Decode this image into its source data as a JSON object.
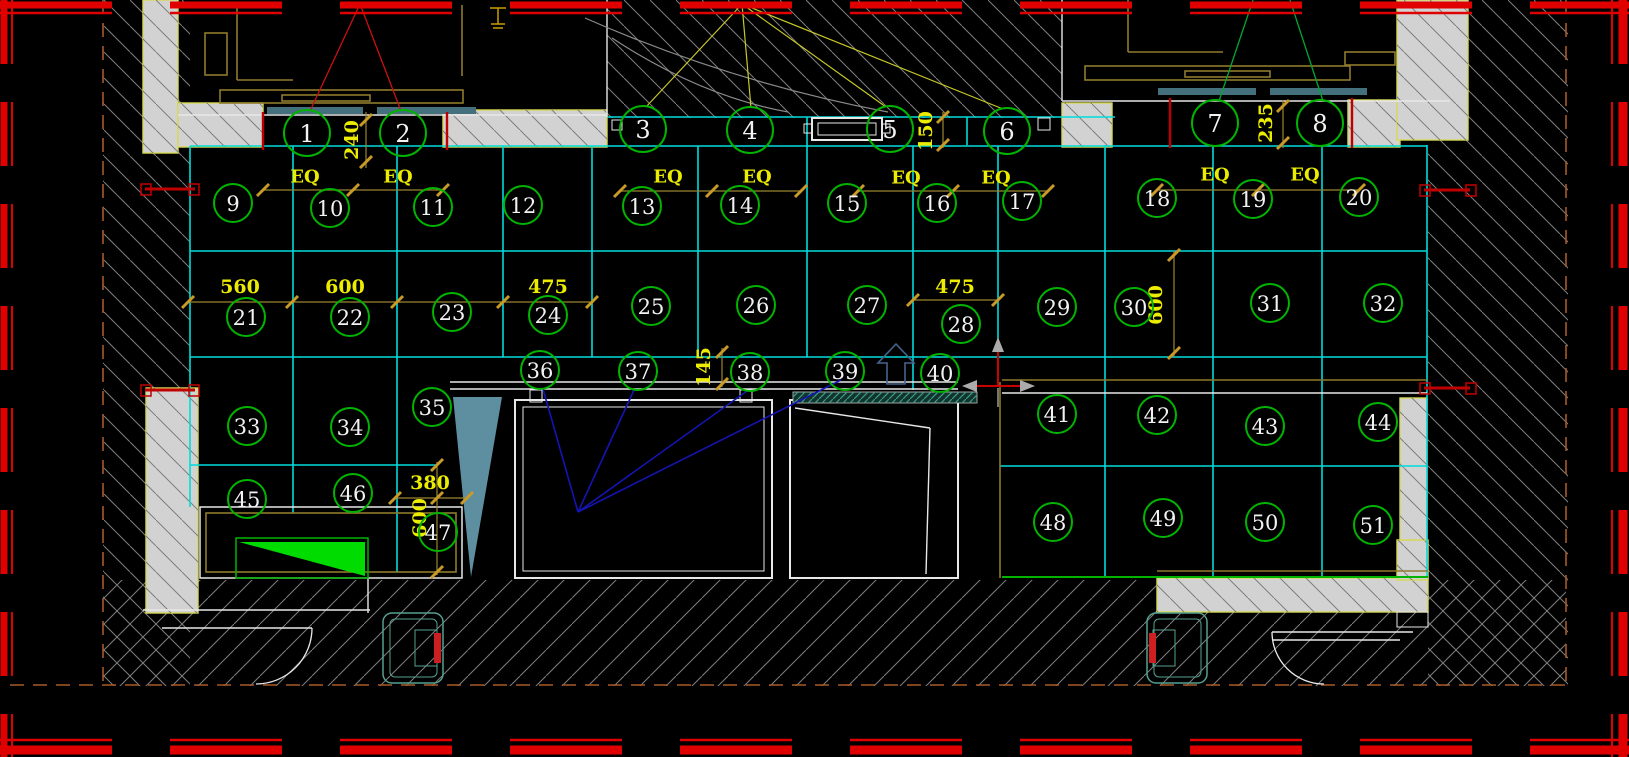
{
  "canvas": {
    "w": 1629,
    "h": 757
  },
  "colors": {
    "bg": "#000000",
    "red": "#E00000",
    "red_dark": "#C00000",
    "orange_dash": "#A85A28",
    "hatch": "#7E7E7E",
    "gray_wall": "#D2D2D2",
    "wall_edge": "#D8D855",
    "cyan": "#00DCDC",
    "white": "#E8E8E8",
    "khaki": "#8F7A2E",
    "gold": "#C89B28",
    "yellow_text": "#ECEC00",
    "circle_green": "#00B400",
    "leader_red": "#CC1010",
    "leader_yellow": "#C8C828",
    "leader_green": "#00A830",
    "leader_blue": "#1414B4",
    "teal_bar": "#44707E",
    "steel_tri": "#5E8FA0",
    "green_fill": "#00DC00",
    "door_teal": "#55A090",
    "arc_gray": "#8A8A8A",
    "ucs_gray": "#ABABAB",
    "arrow_blue": "#46648C",
    "strip_fill": "#12342E"
  },
  "border": {
    "top": [
      {
        "y": 5,
        "sw": 7
      },
      {
        "y": 13,
        "sw": 2.5
      }
    ],
    "bottom": [
      {
        "y": 740,
        "sw": 2.5
      },
      {
        "y": 750,
        "sw": 9
      }
    ],
    "left": [
      {
        "x": 4,
        "sw": 7
      },
      {
        "x": 12,
        "sw": 2
      }
    ],
    "right": [
      {
        "x": 1612,
        "sw": 2
      },
      {
        "x": 1623,
        "sw": 9
      }
    ],
    "dash_h": "112 58",
    "dash_v": "64 38"
  },
  "orange_dashes": [
    [
      103,
      0,
      103,
      685
    ],
    [
      1566,
      0,
      1566,
      685
    ],
    [
      10,
      685,
      1566,
      685
    ]
  ],
  "hatch_back": [
    [
      103,
      0,
      87,
      686
    ],
    [
      607,
      0,
      455,
      118
    ],
    [
      1428,
      0,
      140,
      686
    ]
  ],
  "hatch_fwd": [
    [
      103,
      580,
      1463,
      106
    ]
  ],
  "gray_walls": [
    [
      143,
      0,
      35,
      153
    ],
    [
      178,
      103,
      85,
      44
    ],
    [
      443,
      110,
      164,
      37
    ],
    [
      1062,
      103,
      50,
      44
    ],
    [
      1348,
      100,
      52,
      47
    ],
    [
      1397,
      0,
      71,
      140
    ],
    [
      146,
      388,
      52,
      225
    ],
    [
      1157,
      578,
      271,
      34
    ],
    [
      1397,
      540,
      31,
      40
    ],
    [
      1400,
      398,
      27,
      142
    ]
  ],
  "grid_h": [
    [
      117,
      607,
      1115
    ],
    [
      146,
      190,
      1427
    ],
    [
      251,
      190,
      1427
    ],
    [
      357,
      190,
      1427
    ],
    [
      465,
      190,
      437
    ],
    [
      466,
      1000,
      1427
    ]
  ],
  "grid_v": [
    [
      190,
      146,
      507
    ],
    [
      293,
      146,
      513
    ],
    [
      397,
      146,
      572
    ],
    [
      503,
      146,
      357
    ],
    [
      592,
      146,
      357
    ],
    [
      698,
      146,
      357
    ],
    [
      807,
      117,
      357
    ],
    [
      913,
      146,
      390
    ],
    [
      967,
      117,
      145
    ],
    [
      998,
      146,
      382
    ],
    [
      1105,
      145,
      578
    ],
    [
      1213,
      145,
      578
    ],
    [
      1322,
      145,
      578
    ],
    [
      1427,
      145,
      578
    ]
  ],
  "white_lines": [
    [
      178,
      115,
      607,
      115
    ],
    [
      1062,
      101,
      1450,
      101
    ],
    [
      450,
      382,
      958,
      382
    ],
    [
      450,
      389,
      958,
      389
    ],
    [
      607,
      0,
      607,
      117
    ],
    [
      1062,
      0,
      1062,
      101
    ],
    [
      795,
      408,
      930,
      428
    ],
    [
      930,
      428,
      926,
      574
    ],
    [
      143,
      610,
      370,
      610
    ],
    [
      162,
      628,
      312,
      628
    ],
    [
      368,
      578,
      368,
      613
    ],
    [
      1272,
      632,
      1413,
      632
    ],
    [
      1272,
      640,
      1400,
      640
    ],
    [
      1002,
      393,
      1427,
      393
    ]
  ],
  "white_rects": [
    [
      515,
      400,
      257,
      178,
      2
    ],
    [
      523,
      407,
      241,
      164,
      1
    ],
    [
      790,
      400,
      168,
      178,
      2
    ],
    [
      812,
      118,
      70,
      22,
      2
    ],
    [
      818,
      123,
      58,
      12,
      1
    ],
    [
      804,
      124,
      8,
      9,
      1
    ],
    [
      882,
      124,
      8,
      9,
      1
    ],
    [
      612,
      120,
      10,
      10,
      1
    ],
    [
      1038,
      118,
      12,
      12,
      1
    ],
    [
      530,
      390,
      12,
      12,
      1
    ],
    [
      740,
      390,
      12,
      12,
      1
    ],
    [
      200,
      507,
      262,
      71,
      1.5
    ],
    [
      1397,
      612,
      31,
      15,
      1
    ]
  ],
  "khaki_lines": [
    [
      237,
      8,
      237,
      80
    ],
    [
      237,
      80,
      293,
      80
    ],
    [
      462,
      5,
      462,
      76
    ],
    [
      1128,
      0,
      1128,
      52
    ],
    [
      1128,
      52,
      1223,
      52
    ],
    [
      1000,
      382,
      1000,
      578
    ],
    [
      1002,
      380,
      1427,
      380
    ],
    [
      1157,
      571,
      1428,
      571
    ]
  ],
  "khaki_rects": [
    [
      205,
      33,
      22,
      42
    ],
    [
      220,
      90,
      243,
      13
    ],
    [
      282,
      95,
      88,
      6
    ],
    [
      1085,
      66,
      265,
      14
    ],
    [
      1185,
      71,
      85,
      6
    ],
    [
      1345,
      52,
      50,
      13
    ],
    [
      206,
      513,
      250,
      59
    ]
  ],
  "teal_bars": [
    [
      267,
      107,
      96,
      7
    ],
    [
      377,
      107,
      99,
      7
    ],
    [
      1158,
      88,
      98,
      7
    ],
    [
      1270,
      88,
      97,
      7
    ]
  ],
  "teal_strip": [
    793,
    392,
    184,
    11
  ],
  "door_boxes": [
    {
      "x": 383,
      "y": 613,
      "w": 60,
      "h": 70,
      "red_side": "right"
    },
    {
      "x": 1147,
      "y": 613,
      "w": 60,
      "h": 70,
      "red_side": "left"
    }
  ],
  "green_line": [
    1002,
    577,
    1428,
    577
  ],
  "green_block": {
    "outline": [
      236,
      538,
      132,
      40
    ],
    "tri": "M 239 542 L 365 542 L 365 576 Z"
  },
  "red_pocket_ticks": [
    [
      263,
      112,
      263,
      150
    ],
    [
      447,
      112,
      447,
      150
    ],
    [
      1170,
      98,
      1170,
      148
    ],
    [
      1352,
      98,
      1352,
      148
    ]
  ],
  "red_openings": {
    "bars": [
      [
        145,
        189,
        195,
        189
      ],
      [
        145,
        390,
        195,
        390
      ],
      [
        1424,
        190,
        1470,
        190
      ],
      [
        1424,
        388,
        1470,
        388
      ]
    ],
    "caps": [
      [
        141,
        184,
        10,
        11
      ],
      [
        189,
        184,
        10,
        11
      ],
      [
        141,
        385,
        10,
        11
      ],
      [
        189,
        385,
        10,
        11
      ],
      [
        1420,
        185,
        10,
        11
      ],
      [
        1466,
        185,
        10,
        11
      ],
      [
        1420,
        383,
        10,
        11
      ],
      [
        1466,
        383,
        10,
        11
      ]
    ]
  },
  "leaders": {
    "red": [
      [
        360,
        4,
        310,
        111
      ],
      [
        360,
        4,
        401,
        111
      ]
    ],
    "yellow": [
      [
        742,
        4,
        646,
        107
      ],
      [
        742,
        4,
        751,
        108
      ],
      [
        742,
        4,
        886,
        107
      ],
      [
        742,
        4,
        1003,
        109
      ]
    ],
    "green": [
      [
        1253,
        0,
        1219,
        101
      ],
      [
        1290,
        0,
        1323,
        101
      ]
    ],
    "blue": [
      [
        578,
        512,
        543,
        389
      ],
      [
        578,
        512,
        634,
        390
      ],
      [
        578,
        512,
        747,
        391
      ],
      [
        578,
        512,
        841,
        380
      ]
    ]
  },
  "dims": {
    "lines_h": [
      [
        190,
        263,
        443
      ],
      [
        191,
        620,
        801
      ],
      [
        191,
        858,
        1048
      ],
      [
        190,
        1157,
        1359
      ],
      [
        302,
        188,
        592
      ],
      [
        300,
        913,
        998
      ],
      [
        498,
        395,
        467
      ]
    ],
    "lines_v": [
      [
        366,
        112,
        168
      ],
      [
        943,
        112,
        148
      ],
      [
        1283,
        100,
        148
      ],
      [
        1174,
        251,
        357
      ],
      [
        722,
        348,
        387
      ],
      [
        437,
        462,
        575
      ]
    ],
    "ticks": [
      [
        263,
        190
      ],
      [
        353,
        190
      ],
      [
        443,
        190
      ],
      [
        620,
        191
      ],
      [
        712,
        191
      ],
      [
        801,
        191
      ],
      [
        858,
        191
      ],
      [
        953,
        191
      ],
      [
        1048,
        191
      ],
      [
        1157,
        190
      ],
      [
        1258,
        190
      ],
      [
        1359,
        190
      ],
      [
        188,
        302
      ],
      [
        292,
        302
      ],
      [
        397,
        302
      ],
      [
        503,
        302
      ],
      [
        592,
        302
      ],
      [
        913,
        300
      ],
      [
        998,
        300
      ],
      [
        395,
        498
      ],
      [
        467,
        498
      ],
      [
        366,
        120
      ],
      [
        366,
        162
      ],
      [
        943,
        117
      ],
      [
        943,
        145
      ],
      [
        1283,
        106
      ],
      [
        1283,
        143
      ],
      [
        1174,
        255
      ],
      [
        1174,
        353
      ],
      [
        722,
        352
      ],
      [
        722,
        384
      ],
      [
        437,
        465
      ],
      [
        437,
        498
      ],
      [
        437,
        572
      ]
    ],
    "texts": [
      {
        "t": "240",
        "x": 352,
        "y": 140,
        "rot": -90,
        "s": 19
      },
      {
        "t": "150",
        "x": 926,
        "y": 131,
        "rot": -90,
        "s": 19
      },
      {
        "t": "235",
        "x": 1266,
        "y": 123,
        "rot": -90,
        "s": 19
      },
      {
        "t": "560",
        "x": 240,
        "y": 287,
        "rot": 0,
        "s": 19
      },
      {
        "t": "600",
        "x": 345,
        "y": 287,
        "rot": 0,
        "s": 19
      },
      {
        "t": "475",
        "x": 548,
        "y": 287,
        "rot": 0,
        "s": 19
      },
      {
        "t": "475",
        "x": 955,
        "y": 287,
        "rot": 0,
        "s": 19
      },
      {
        "t": "600",
        "x": 1156,
        "y": 305,
        "rot": -90,
        "s": 19
      },
      {
        "t": "145",
        "x": 704,
        "y": 367,
        "rot": -90,
        "s": 19
      },
      {
        "t": "380",
        "x": 430,
        "y": 483,
        "rot": 0,
        "s": 19
      },
      {
        "t": "600",
        "x": 420,
        "y": 518,
        "rot": -90,
        "s": 19
      }
    ]
  },
  "eq": {
    "label": "EQ",
    "size": 18,
    "positions": [
      [
        305,
        177
      ],
      [
        398,
        177
      ],
      [
        668,
        177
      ],
      [
        757,
        177
      ],
      [
        906,
        178
      ],
      [
        996,
        178
      ],
      [
        1215,
        175
      ],
      [
        1305,
        175
      ]
    ]
  },
  "callouts": [
    [
      1,
      307,
      133,
      23
    ],
    [
      2,
      403,
      133,
      23
    ],
    [
      3,
      643,
      129,
      23
    ],
    [
      4,
      750,
      130,
      23
    ],
    [
      5,
      890,
      129,
      23
    ],
    [
      6,
      1007,
      131,
      23
    ],
    [
      7,
      1215,
      123,
      23
    ],
    [
      8,
      1320,
      123,
      23
    ],
    [
      9,
      233,
      203,
      19
    ],
    [
      10,
      330,
      208,
      19
    ],
    [
      11,
      433,
      207,
      19
    ],
    [
      12,
      523,
      205,
      19
    ],
    [
      13,
      642,
      206,
      19
    ],
    [
      14,
      740,
      205,
      19
    ],
    [
      15,
      847,
      203,
      19
    ],
    [
      16,
      937,
      203,
      19
    ],
    [
      17,
      1022,
      201,
      19
    ],
    [
      18,
      1157,
      198,
      19
    ],
    [
      19,
      1253,
      199,
      19
    ],
    [
      20,
      1359,
      197,
      19
    ],
    [
      21,
      246,
      317,
      19
    ],
    [
      22,
      350,
      317,
      19
    ],
    [
      23,
      452,
      312,
      19
    ],
    [
      24,
      548,
      315,
      19
    ],
    [
      25,
      651,
      306,
      19
    ],
    [
      26,
      756,
      305,
      19
    ],
    [
      27,
      867,
      305,
      19
    ],
    [
      28,
      961,
      324,
      19
    ],
    [
      29,
      1057,
      307,
      19
    ],
    [
      30,
      1134,
      307,
      19
    ],
    [
      31,
      1270,
      303,
      19
    ],
    [
      32,
      1383,
      303,
      19
    ],
    [
      33,
      247,
      426,
      19
    ],
    [
      34,
      350,
      427,
      19
    ],
    [
      35,
      432,
      407,
      19
    ],
    [
      36,
      540,
      370,
      19
    ],
    [
      37,
      638,
      371,
      19
    ],
    [
      38,
      750,
      372,
      19
    ],
    [
      39,
      845,
      371,
      19
    ],
    [
      40,
      940,
      373,
      19
    ],
    [
      41,
      1057,
      414,
      19
    ],
    [
      42,
      1157,
      415,
      19
    ],
    [
      43,
      1265,
      426,
      19
    ],
    [
      44,
      1378,
      422,
      19
    ],
    [
      45,
      247,
      499,
      19
    ],
    [
      46,
      353,
      493,
      19
    ],
    [
      47,
      438,
      532,
      19
    ],
    [
      48,
      1053,
      522,
      19
    ],
    [
      49,
      1163,
      518,
      19
    ],
    [
      50,
      1265,
      522,
      19
    ],
    [
      51,
      1373,
      525,
      19
    ]
  ],
  "paths": [
    {
      "name": "swing-arc-outer",
      "d": "M 585 18 Q 730 82 888 112",
      "stroke": "#8A8A8A",
      "sw": 1.2,
      "fill": "none"
    },
    {
      "name": "swing-arc-inner",
      "d": "M 612 38 Q 700 96 788 112",
      "stroke": "#8A8A8A",
      "sw": 1.2,
      "fill": "none"
    },
    {
      "name": "door-arc-left",
      "d": "M 312 628 A 56 56 0 0 1 256 684",
      "stroke": "#E8E8E8",
      "sw": 1.3,
      "fill": "none"
    },
    {
      "name": "door-arc-right",
      "d": "M 1272 632 A 52 52 0 0 0 1324 684",
      "stroke": "#E8E8E8",
      "sw": 1.3,
      "fill": "none"
    },
    {
      "name": "steel-triangle",
      "d": "M 453 397 L 502 397 L 471 577 Z",
      "stroke": "none",
      "sw": 0,
      "fill": "#5E8FA0"
    },
    {
      "name": "north-arrow",
      "d": "M 896 344 L 878 363 L 887 363 L 887 384 L 905 384 L 905 363 L 914 363 Z",
      "stroke": "#46648C",
      "sw": 1.6,
      "fill": "none"
    },
    {
      "name": "ucs-axes",
      "d": "M 998 386 L 998 350 M 975 386 L 1022 386",
      "stroke": "#CC0000",
      "sw": 2,
      "fill": "none"
    },
    {
      "name": "ucs-arrow-up",
      "d": "M 992 352 L 1004 352 L 998 337 Z",
      "stroke": "none",
      "sw": 0,
      "fill": "#ABABAB"
    },
    {
      "name": "ucs-arrow-right",
      "d": "M 1020 380 L 1020 392 L 1035 386 Z",
      "stroke": "none",
      "sw": 0,
      "fill": "#ABABAB"
    },
    {
      "name": "ucs-arrow-left",
      "d": "M 977 380 L 977 392 L 962 386 Z",
      "stroke": "none",
      "sw": 0,
      "fill": "#ABABAB"
    },
    {
      "name": "ucs-tail",
      "d": "M 998 388 L 998 407",
      "stroke": "#E8E8E8",
      "sw": 1,
      "fill": "none"
    },
    {
      "name": "wall-lamp",
      "d": "M 490 8 L 506 8 M 498 8 L 498 24 M 491 24 L 505 24 M 493 28 L 503 28",
      "stroke": "#C8A000",
      "sw": 1.5,
      "fill": "none"
    }
  ]
}
